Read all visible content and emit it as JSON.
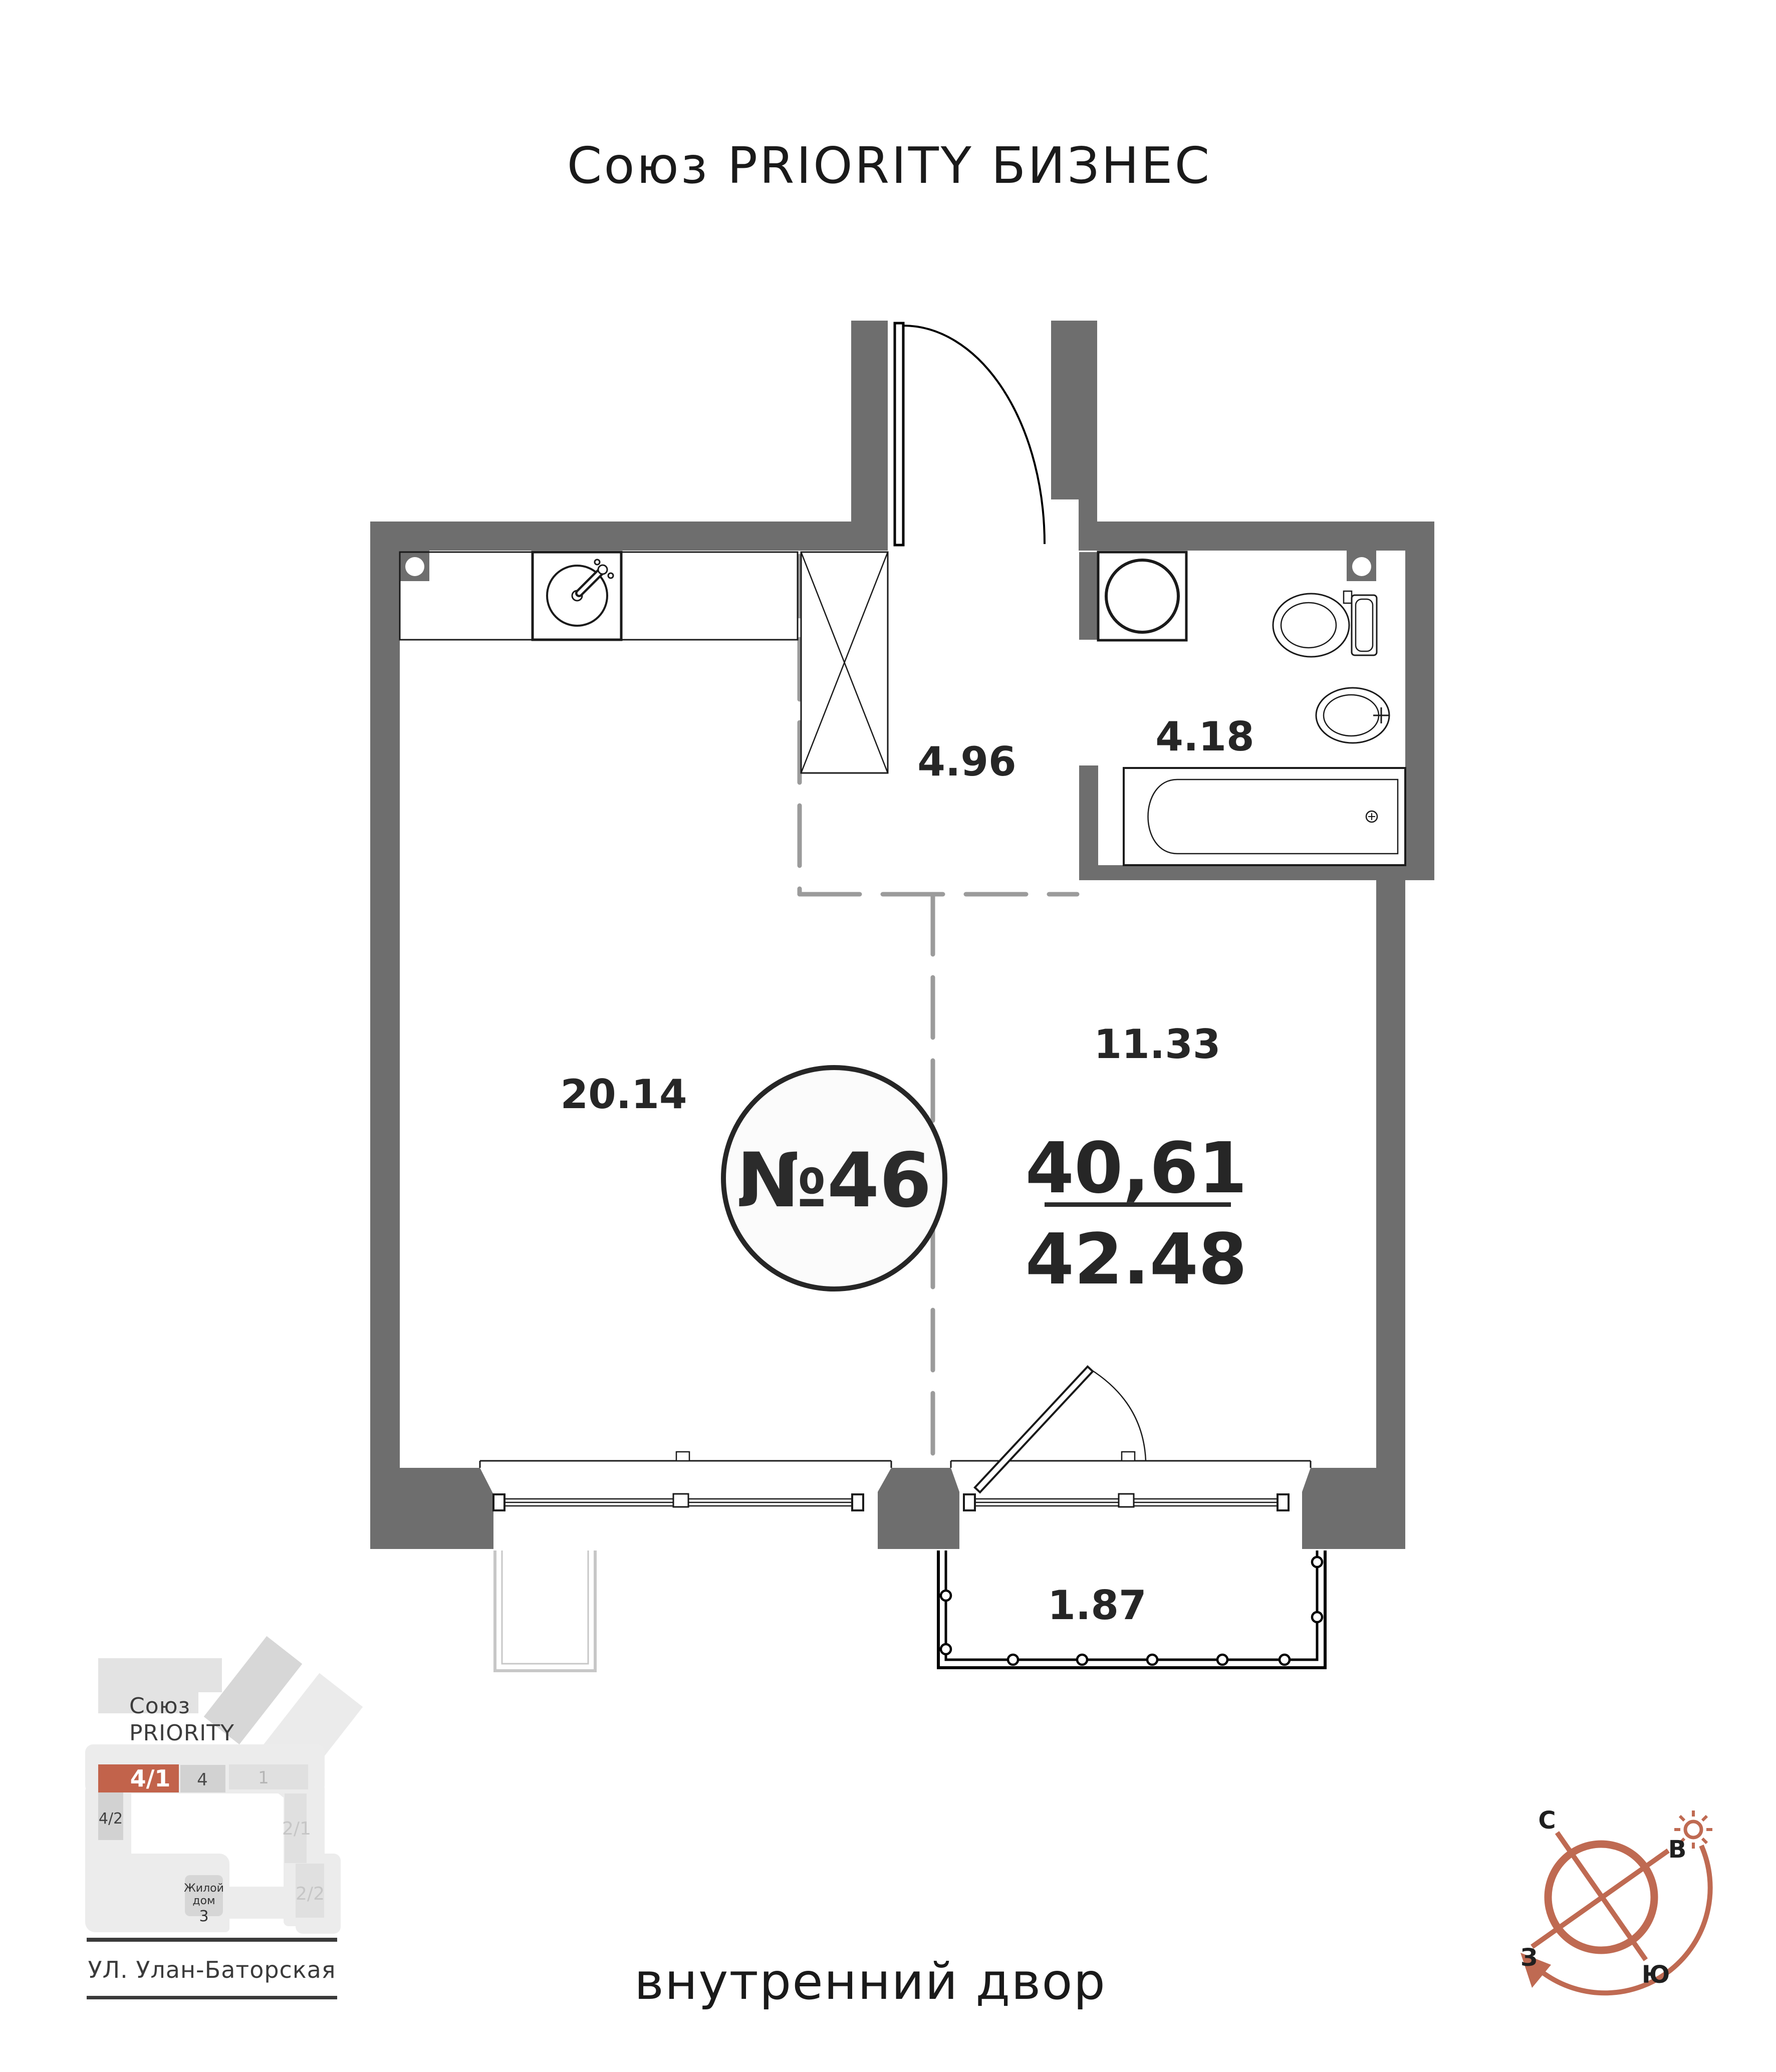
{
  "title": "Союз PRIORITY БИЗНЕС",
  "plan": {
    "unit_number": "№46",
    "area_living": "40,61",
    "area_total": "42.48",
    "rooms": {
      "hallway": "4.96",
      "bathroom": "4.18",
      "kitchen_zone": "11.33",
      "living_zone": "20.14",
      "balcony": "1.87"
    }
  },
  "minimap": {
    "project_line1": "Союз",
    "project_line2": "PRIORITY",
    "blocks": {
      "b41": "4/1",
      "b4": "4",
      "b1": "1",
      "b42": "4/2",
      "b21": "2/1",
      "b22": "2/2"
    },
    "house_line1": "Жилой",
    "house_line2": "дом",
    "house_number": "3",
    "street": "УЛ. Улан-Баторская"
  },
  "footer": {
    "courtyard": "внутренний двор"
  },
  "compass": {
    "north": "С",
    "east": "В",
    "west": "З",
    "south": "Ю"
  },
  "colors": {
    "accent": "#c2634b",
    "wall": "#6e6e6e",
    "dashed": "#9b9b9b",
    "compass": "#bf6a52"
  }
}
